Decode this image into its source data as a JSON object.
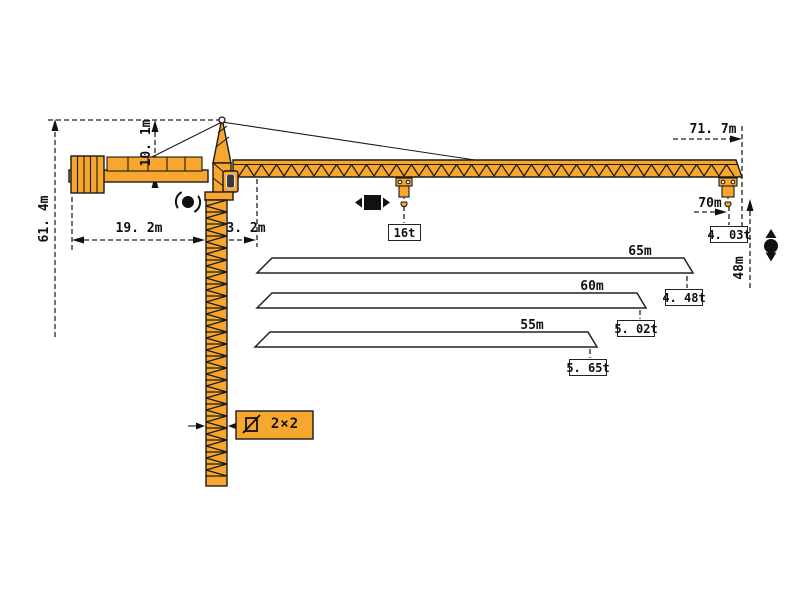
{
  "diagram_title": "tower-crane-load-diagram",
  "colors": {
    "crane": "#F7A62E",
    "outline": "#1A1A1A",
    "background": "#FFFFFF"
  },
  "dimensions": {
    "total_height": "61. 4m",
    "head_height": "10. 1m",
    "counter_jib_radius": "19. 2m",
    "mast_width": "3. 2m",
    "max_working_radius": "71. 7m",
    "tip_radius": "70m",
    "lift_height": "48m",
    "mast_section": "2×2"
  },
  "loads": {
    "max_load": "16t",
    "tip_load": "4. 03t"
  },
  "jib_options": [
    {
      "length": "65m",
      "tip_load": "4. 48t"
    },
    {
      "length": "60m",
      "tip_load": "5. 02t"
    },
    {
      "length": "55m",
      "tip_load": "5. 65t"
    }
  ],
  "symbols": {
    "slewing": "slewing-rotation",
    "trolley": "trolley-travel",
    "hoist": "hoist-up-down",
    "section": "mast-cross-section"
  }
}
